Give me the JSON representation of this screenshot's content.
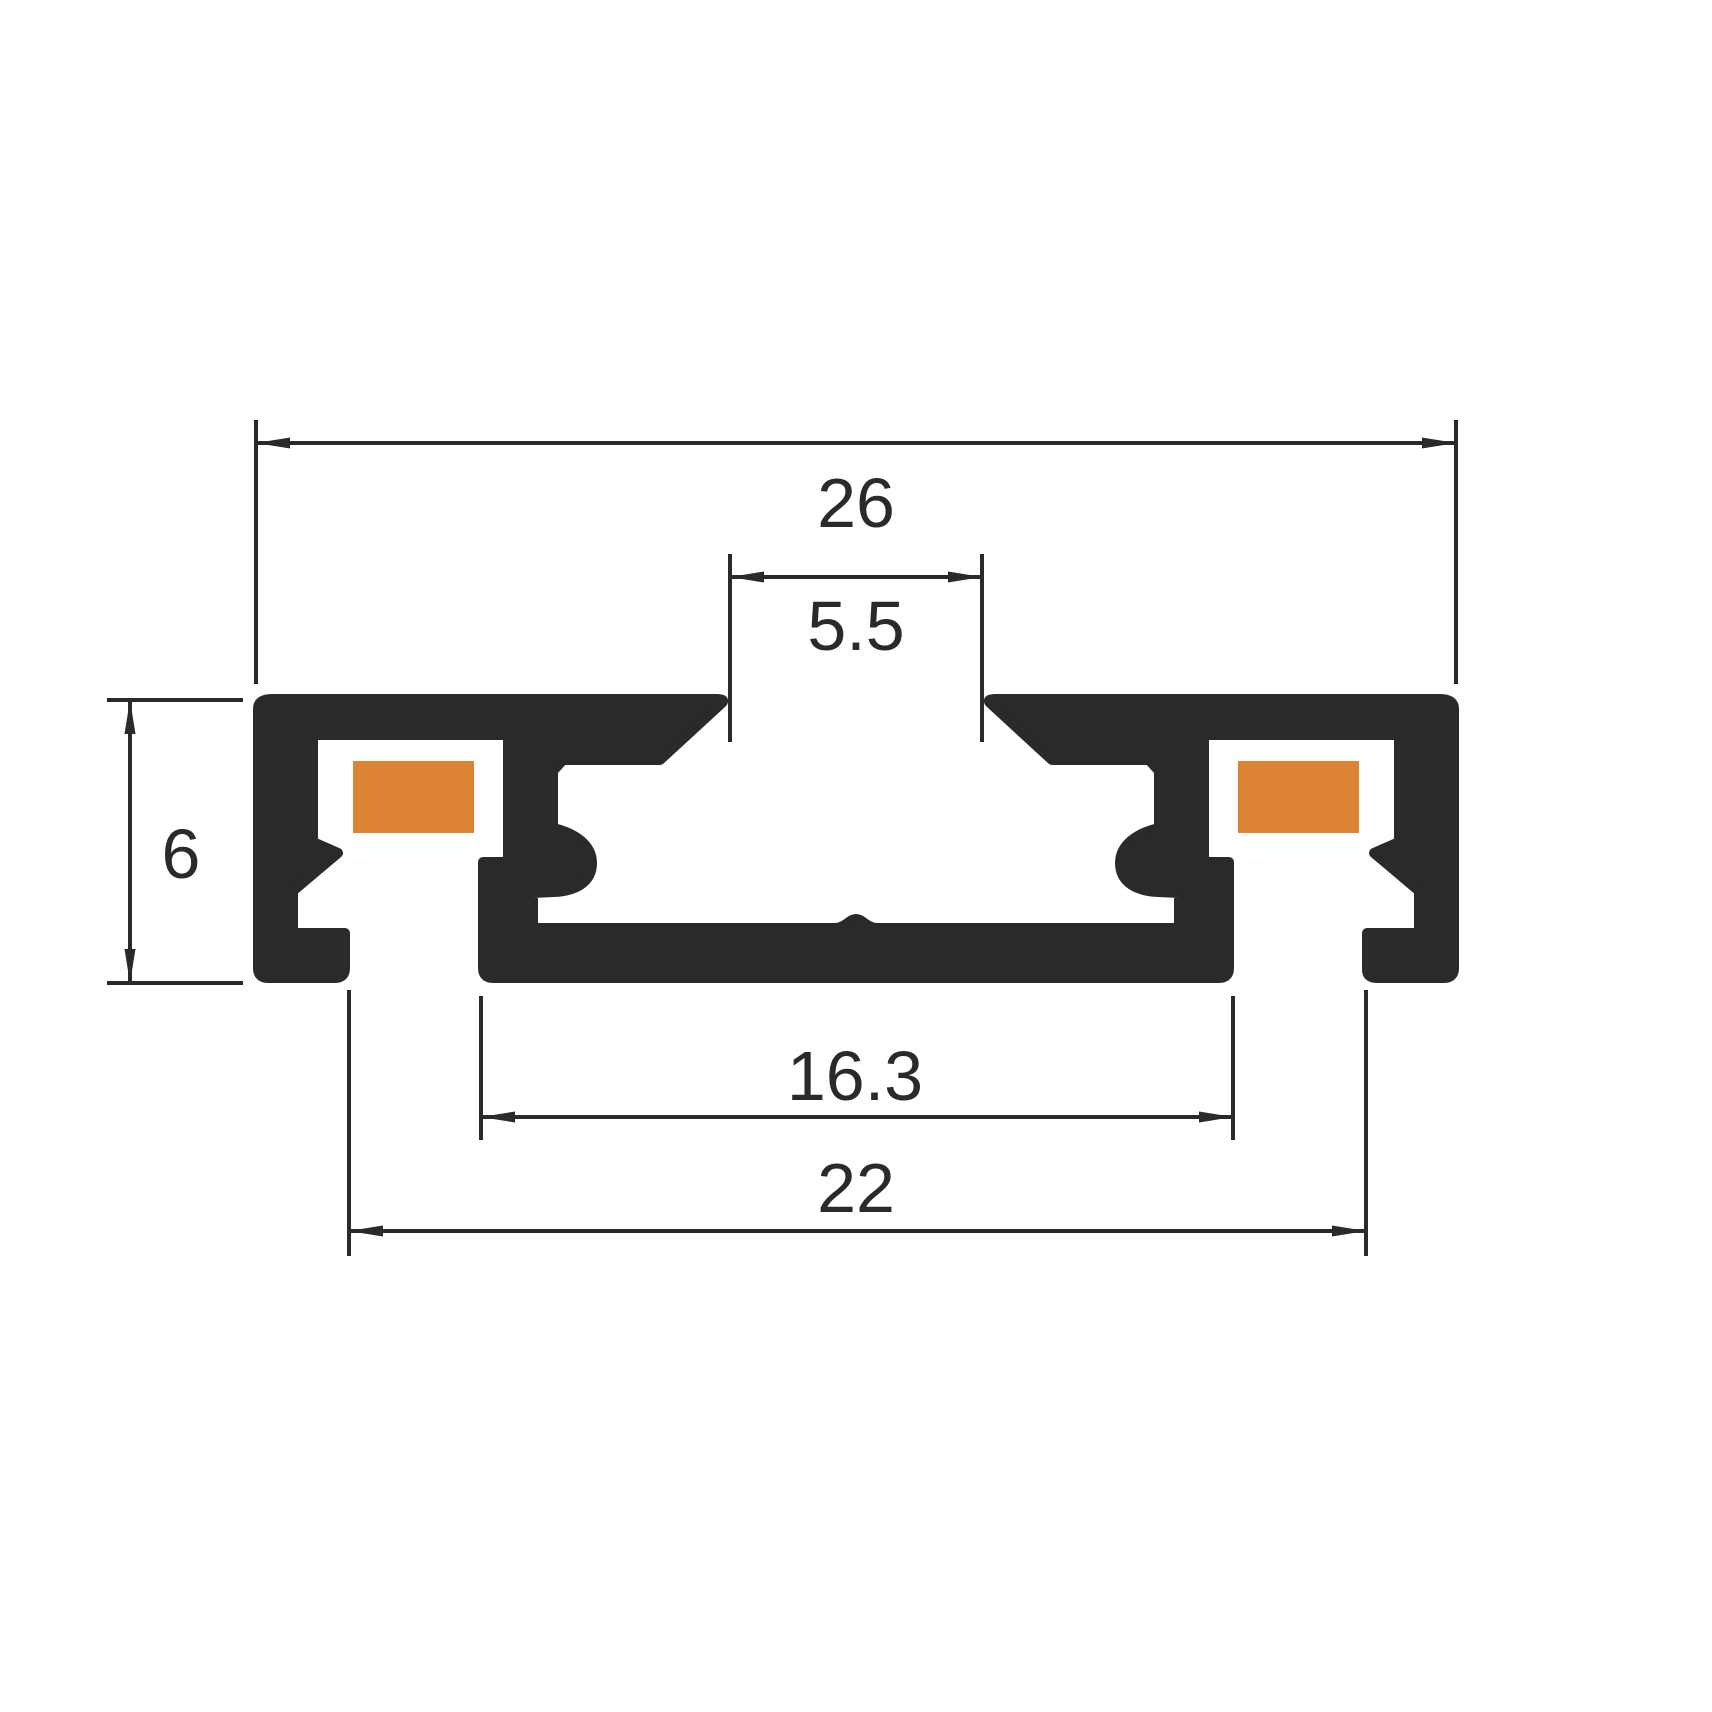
{
  "drawing": {
    "kind": "aluminium LED profile cross-section, dimensioned technical drawing",
    "background": "#ffffff"
  },
  "colors": {
    "ink": "#2b2a29",
    "led_strip": "#dd8434"
  },
  "dimensions": {
    "overall_width": "26",
    "top_opening": "5.5",
    "height": "6",
    "inner_width": "16.3",
    "base_width": "22"
  }
}
